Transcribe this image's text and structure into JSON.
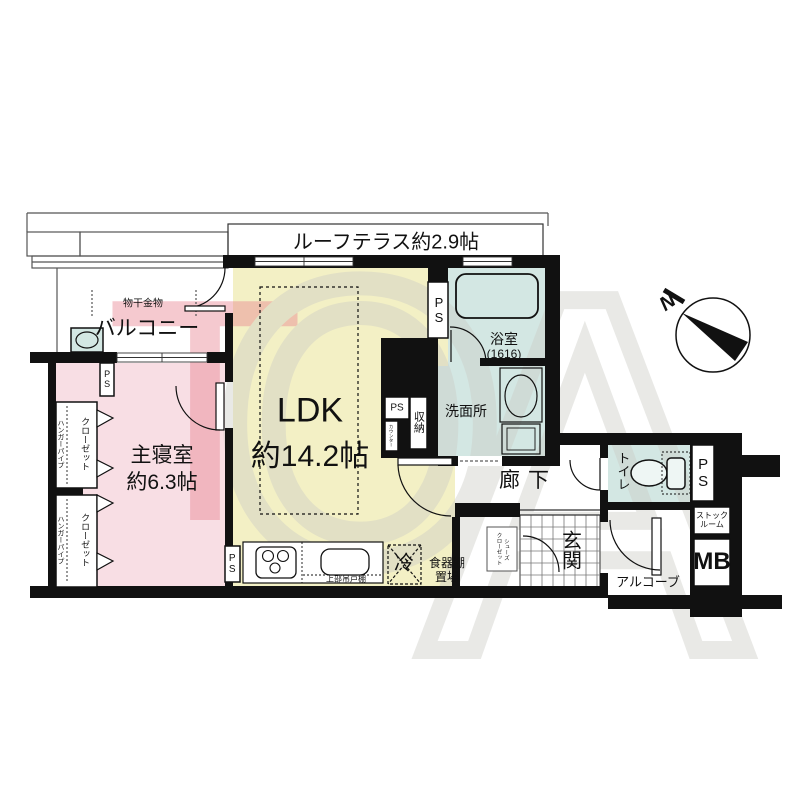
{
  "watermark": {
    "letters": [
      "T",
      "O",
      "A"
    ]
  },
  "compass": {
    "north_label": "N"
  },
  "rooms": {
    "roof_terrace": {
      "label": "ルーフテラス約2.9帖"
    },
    "balcony": {
      "label": "バルコニー"
    },
    "ldk": {
      "label": "LDK",
      "size": "約14.2帖"
    },
    "bedroom": {
      "label": "主寝室",
      "size": "約6.3帖"
    },
    "bathroom": {
      "label": "浴室",
      "size": "(1616)"
    },
    "washroom": {
      "label": "洗面所"
    },
    "hallway": {
      "label": "廊下"
    },
    "toilet": {
      "label": "トイレ"
    },
    "entrance": {
      "label": "玄関"
    },
    "alcove": {
      "label": "アルコーブ"
    },
    "stock_room": {
      "line1": "ストック",
      "line2": "ルーム"
    },
    "meter_box": {
      "label": "MB"
    }
  },
  "features": {
    "laundry_hardware": "物干金物",
    "closet": "クローゼット",
    "hanger_pipe": "ハンガーパイプ",
    "storage": "収納",
    "counter": "カウンター",
    "shoe_closet": {
      "line1": "シューズ",
      "line2": "クローゼット"
    },
    "refrigerator": "冷",
    "cupboard": {
      "line1": "食器棚",
      "line2": "置場"
    },
    "upper_cabinet": "上部吊戸棚",
    "pipe_space": "PS"
  },
  "colors": {
    "ldk": "#f3f0c5",
    "bedroom": "#f8dee4",
    "wet_area": "#d3e7e3",
    "wall": "#111111",
    "watermark_red": "#e8808e",
    "watermark_gray": "#cbcbc6"
  }
}
